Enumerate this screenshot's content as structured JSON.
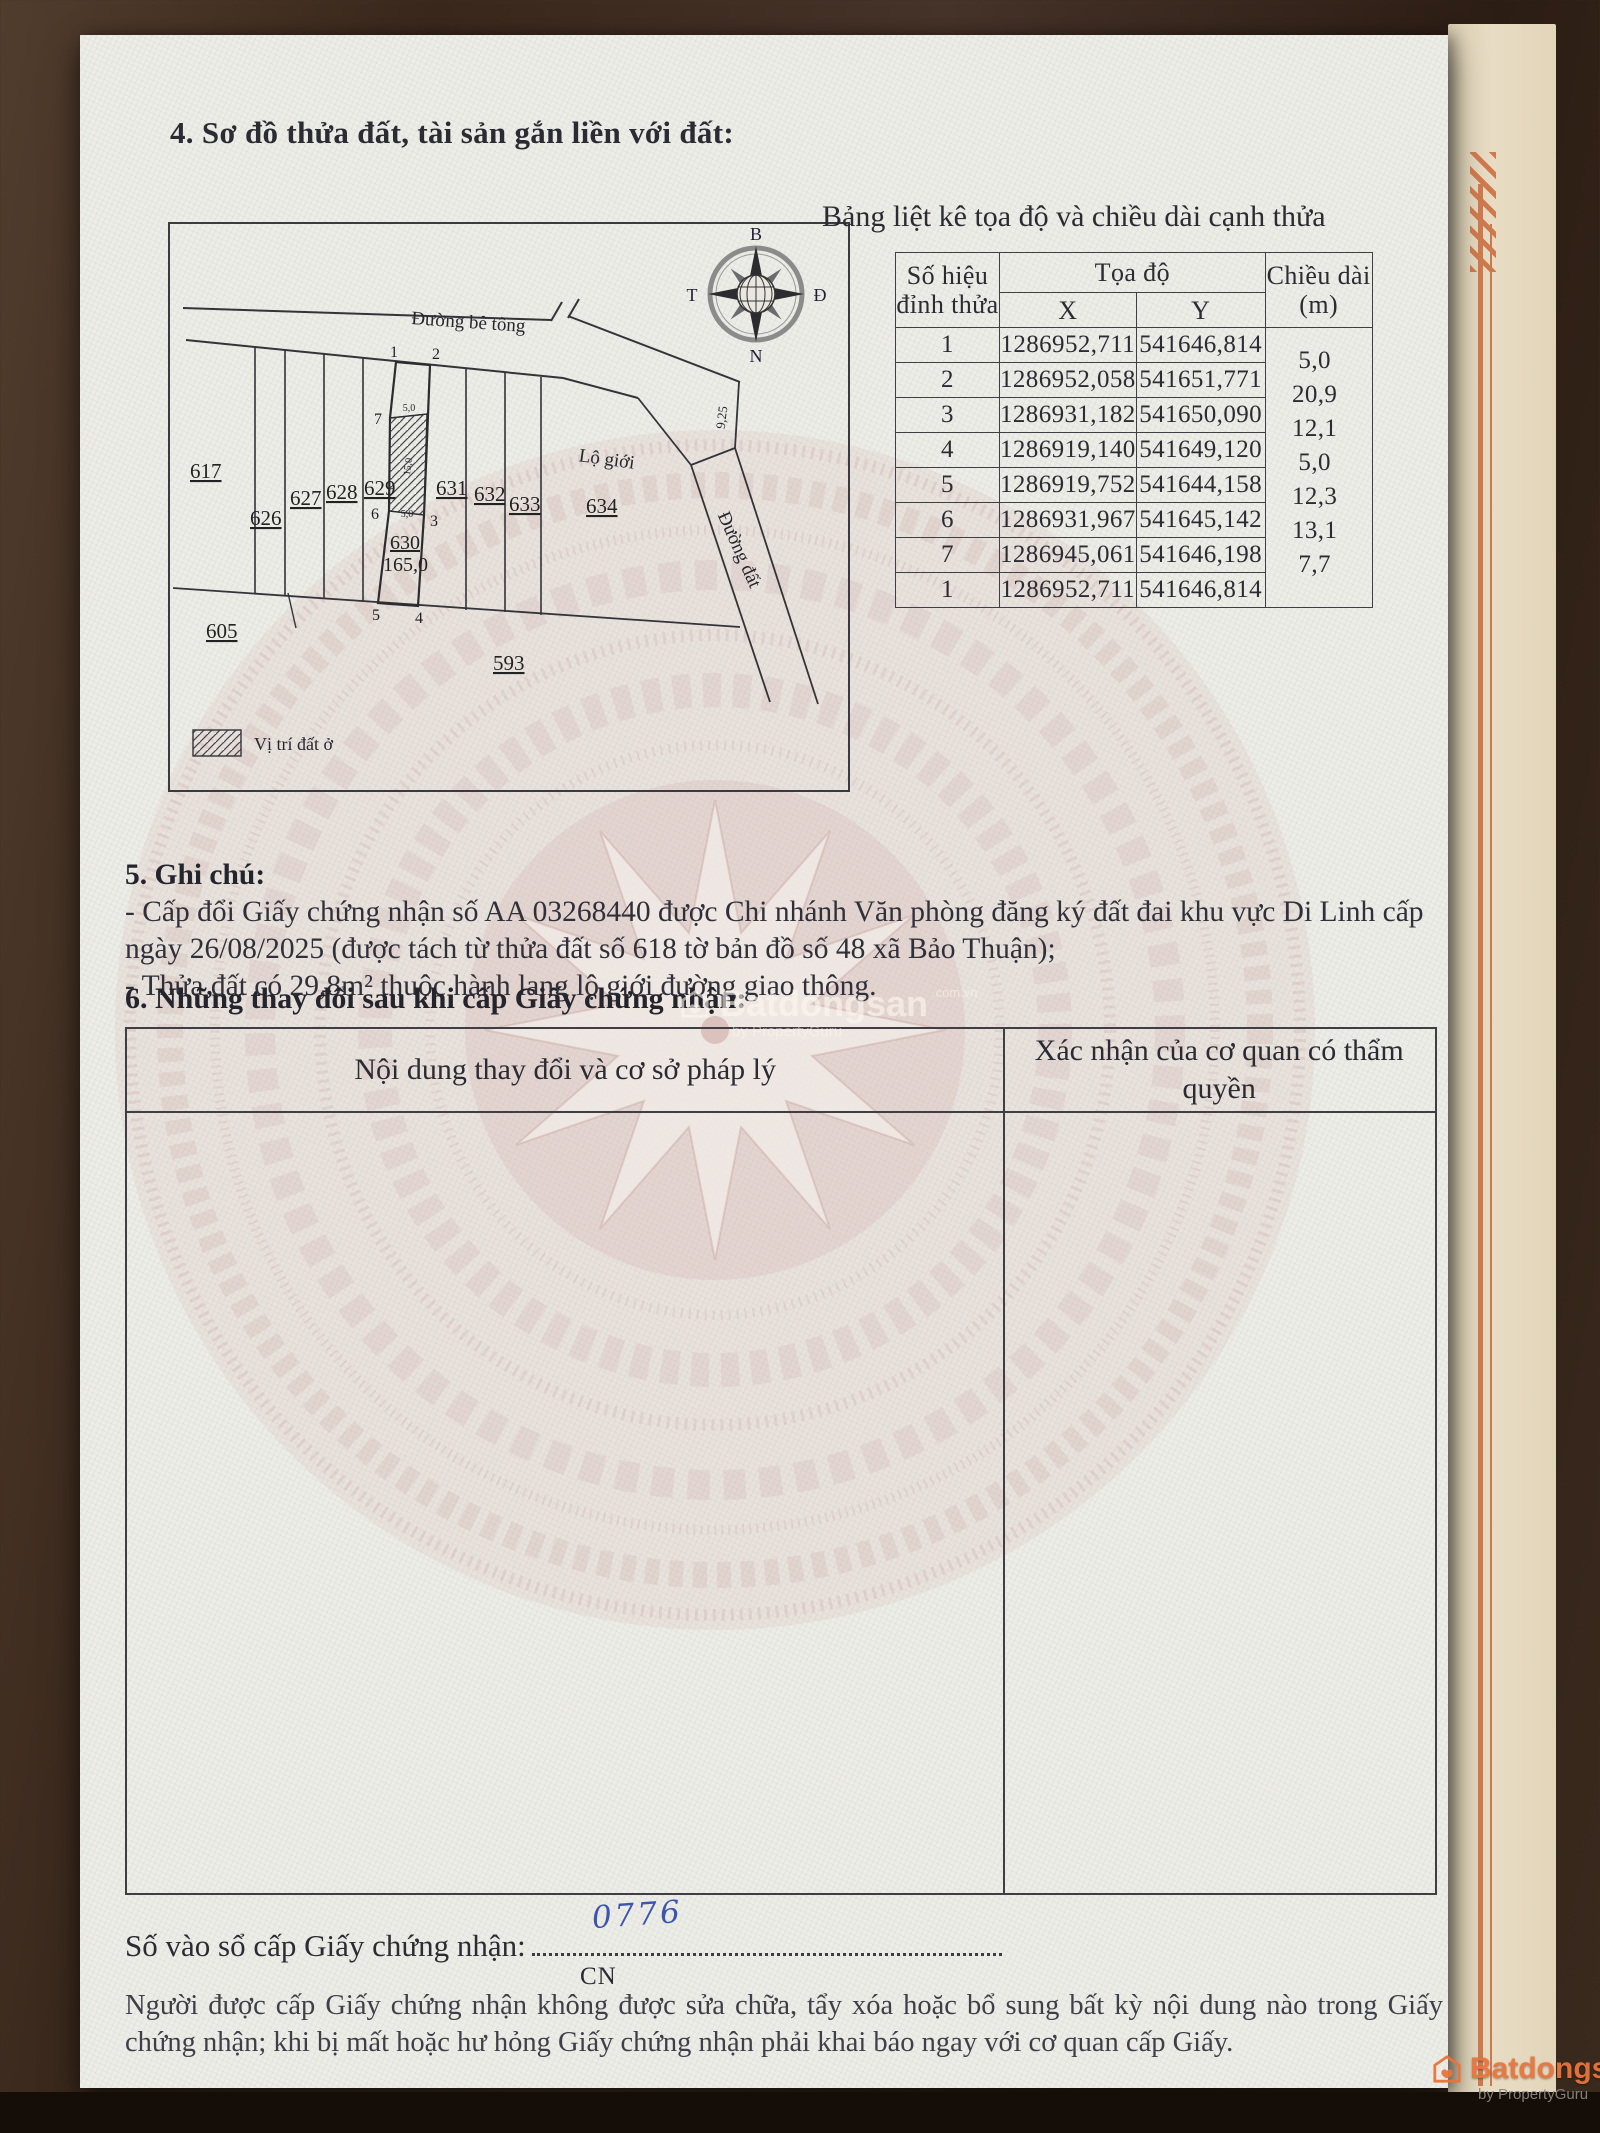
{
  "doc": {
    "section4": {
      "title": "4. Sơ đồ thửa đất, tài sản gắn liền với đất:"
    },
    "map": {
      "compass": {
        "n": "B",
        "s": "N",
        "w": "T",
        "e": "Đ"
      },
      "labels": {
        "road": "Đường bê tông",
        "lo_gioi": "Lộ giới",
        "dirt_road": "Đường đất",
        "edge": "9,25",
        "legend": "Vị trí đất ở"
      },
      "parcels": {
        "p617": "617",
        "p626": "626",
        "p627": "627",
        "p628": "628",
        "p629": "629",
        "p630": "630",
        "p631": "631",
        "p632": "632",
        "p633": "633",
        "p634": "634",
        "p605": "605",
        "p593": "593",
        "area630": "165,0"
      },
      "vertices": {
        "v1": "1",
        "v2": "2",
        "v3": "3",
        "v4": "4",
        "v5": "5",
        "v6": "6",
        "v7": "7"
      },
      "dims": {
        "top": "5,0",
        "side": "15,0",
        "bottom": "5,0"
      }
    },
    "coord_table": {
      "title": "Bảng liệt kê tọa độ và chiều dài cạnh thửa",
      "headers": {
        "vertex": "Số hiệu đỉnh thửa",
        "coords": "Tọa độ",
        "x": "X",
        "y": "Y",
        "len1": "Chiều dài",
        "len2": "(m)"
      },
      "rows": [
        {
          "v": "1",
          "x": "1286952,711",
          "y": "541646,814"
        },
        {
          "v": "2",
          "x": "1286952,058",
          "y": "541651,771"
        },
        {
          "v": "3",
          "x": "1286931,182",
          "y": "541650,090"
        },
        {
          "v": "4",
          "x": "1286919,140",
          "y": "541649,120"
        },
        {
          "v": "5",
          "x": "1286919,752",
          "y": "541644,158"
        },
        {
          "v": "6",
          "x": "1286931,967",
          "y": "541645,142"
        },
        {
          "v": "7",
          "x": "1286945,061",
          "y": "541646,198"
        },
        {
          "v": "1",
          "x": "1286952,711",
          "y": "541646,814"
        }
      ],
      "lengths": [
        "5,0",
        "20,9",
        "12,1",
        "5,0",
        "12,3",
        "13,1",
        "7,7"
      ]
    },
    "section5": {
      "title": "5. Ghi chú:",
      "line1": "- Cấp đổi Giấy chứng nhận số AA 03268440 được Chi nhánh Văn phòng đăng ký đất đai khu vực Di Linh cấp ngày 26/08/2025 (được tách từ thửa đất số 618 tờ bản đồ số 48 xã Bảo Thuận);",
      "line2": "- Thửa đất có 29,8m² thuộc hành lang lộ giới đường giao thông."
    },
    "section6": {
      "title": "6. Những thay đổi sau khi cấp Giấy chứng nhận:",
      "col1": "Nội dung thay đổi và cơ sở pháp lý",
      "col2": "Xác nhận của cơ quan có thẩm quyền"
    },
    "footer": {
      "serial_label": "Số vào sổ cấp Giấy chứng nhận:",
      "serial_value": "0776",
      "serial_sub": "CN",
      "note": "Người được cấp Giấy chứng nhận không được sửa chữa, tẩy xóa hoặc bổ sung bất kỳ nội dung nào trong Giấy chứng nhận; khi bị mất hoặc hư hỏng Giấy chứng nhận phải khai báo ngay với cơ quan cấp Giấy."
    },
    "watermark": {
      "brand": "Batdongsan",
      "domain": ".com.vn",
      "by": "by PropertyGuru"
    }
  }
}
